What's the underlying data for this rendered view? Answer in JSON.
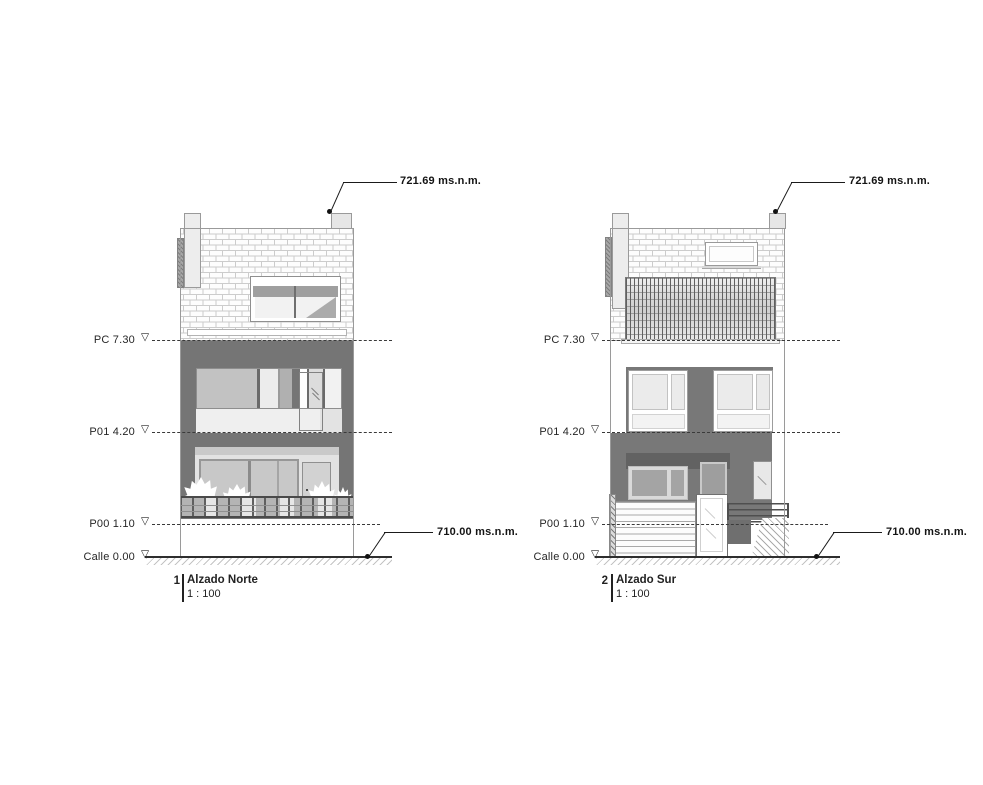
{
  "sheet": {
    "marker_glyph": "▽",
    "elevations": [
      {
        "number": "1",
        "title": "Alzado Norte",
        "scale": "1 : 100",
        "top_altitude": "721.69 ms.n.m.",
        "street_altitude": "710.00 ms.n.m.",
        "levels": [
          {
            "name": "PC",
            "height_m": "7.30",
            "text": "PC 7.30"
          },
          {
            "name": "P01",
            "height_m": "4.20",
            "text": "P01 4.20"
          },
          {
            "name": "P00",
            "height_m": "1.10",
            "text": "P00 1.10"
          },
          {
            "name": "Calle",
            "height_m": "0.00",
            "text": "Calle 0.00"
          }
        ]
      },
      {
        "number": "2",
        "title": "Alzado Sur",
        "scale": "1 : 100",
        "top_altitude": "721.69 ms.n.m.",
        "street_altitude": "710.00 ms.n.m.",
        "levels": [
          {
            "name": "PC",
            "height_m": "7.30",
            "text": "PC 7.30"
          },
          {
            "name": "P01",
            "height_m": "4.20",
            "text": "P01 4.20"
          },
          {
            "name": "P00",
            "height_m": "1.10",
            "text": "P00 1.10"
          },
          {
            "name": "Calle",
            "height_m": "0.00",
            "text": "Calle 0.00"
          }
        ]
      }
    ],
    "colors": {
      "facade_dark": "#757575",
      "facade_deep": "#626262",
      "brick_mortar": "#cccccc",
      "drawing_line": "#2f2f2f",
      "glass_light": "#ebebeb",
      "glass_mid": "#a9a9a9"
    }
  }
}
